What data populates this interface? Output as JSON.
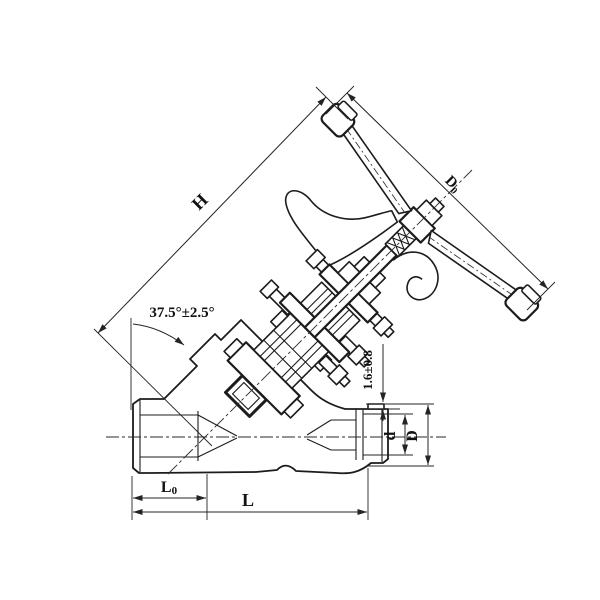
{
  "drawing": {
    "subject": "angle-pattern globe valve with handwheel, sectional technical drawing",
    "background_color": "#ffffff",
    "line_color": "#1c1c1c",
    "dimensions": {
      "height": {
        "label": "H"
      },
      "handwheel_diameter": {
        "main": "D",
        "sub": "0"
      },
      "stem_angle": {
        "label": "37.5°±2.5°"
      },
      "socket_gap": {
        "label": "1.6±0.8"
      },
      "bore_diameter": {
        "label": "d"
      },
      "outer_diameter": {
        "label": "D"
      },
      "port_length": {
        "main": "L",
        "sub": "0"
      },
      "face_to_face": {
        "label": "L"
      }
    }
  }
}
